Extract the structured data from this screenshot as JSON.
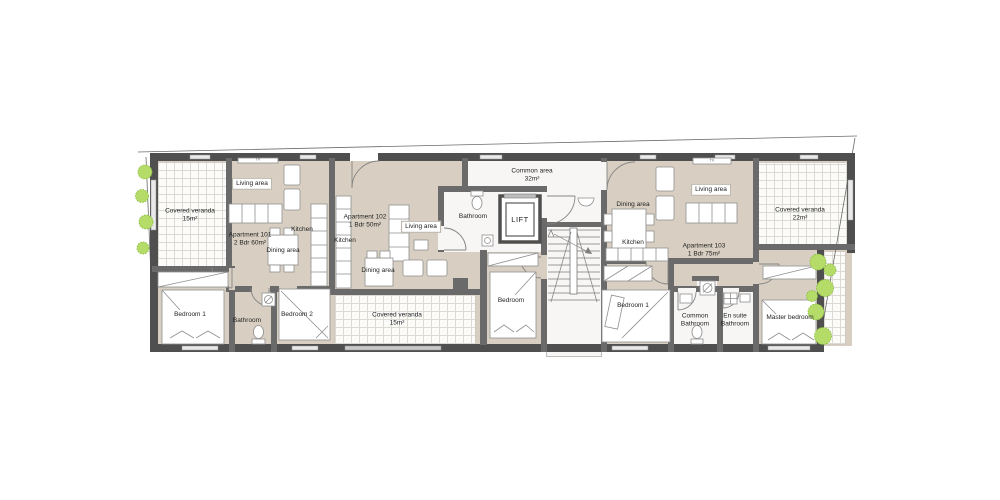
{
  "plan_title": "Apartment building floor plan",
  "colors": {
    "floor": "#d8cfc2",
    "wall_dark": "#4f4f4f",
    "wall_mid": "#6a6a6a",
    "veranda_bg": "#fbfbfa",
    "veranda_grid": "#ddd9d3",
    "plant_green": "#b5dc68",
    "plant_green_dark": "#85bb3a",
    "text": "#1f1f1f"
  },
  "labels": {
    "tv": "TV",
    "apt101": {
      "name": "Apartment 101",
      "spec": "2 Bdr 60m²",
      "living": "Living area",
      "kitchen": "Kitchen",
      "dining": "Dining area",
      "bedroom1": "Bedroom 1",
      "bathroom": "Bathroom",
      "bedroom2": "Bedroom 2",
      "veranda": "Covered veranda",
      "veranda_area": "15m²"
    },
    "apt102": {
      "name": "Apartment 102",
      "spec": "1 Bdr 50m²",
      "kitchen": "Kitchen",
      "living": "Living area",
      "dining": "Dining area",
      "bathroom": "Bathroom",
      "bedroom": "Bedroom",
      "veranda": "Covered veranda",
      "veranda_area": "15m²"
    },
    "common": {
      "name": "Common area",
      "size": "32m²",
      "lift": "LIFT"
    },
    "apt103": {
      "name": "Apartment 103",
      "spec": "1 Bdr 75m²",
      "dining": "Dining area",
      "living": "Living area",
      "kitchen": "Kitchen",
      "bedroom1": "Bedroom 1",
      "common_bath_l1": "Common",
      "common_bath_l2": "Bathroom",
      "ensuite_l1": "En suite",
      "ensuite_l2": "Bathroom",
      "master": "Master bedroom",
      "veranda": "Covered veranda",
      "veranda_area": "22m²"
    }
  }
}
